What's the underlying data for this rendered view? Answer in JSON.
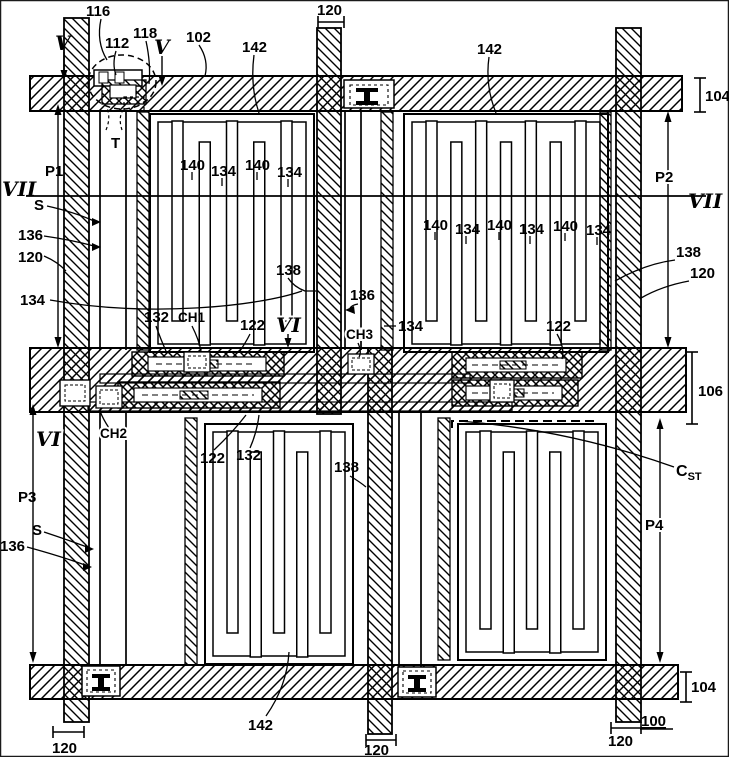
{
  "figure": {
    "type": "patent-drawing",
    "subject": "plan view of thin-film-transistor liquid crystal display pixel array with interdigitated comb electrodes, gate lines, data lines and storage capacitor",
    "section_lines": [
      "V",
      "VI",
      "VII"
    ],
    "labels": [
      {
        "name": "ref-116",
        "text": "116",
        "x": 86,
        "y": 16,
        "c": "num"
      },
      {
        "name": "ref-112",
        "text": "112",
        "x": 105,
        "y": 48,
        "c": "num"
      },
      {
        "name": "ref-118",
        "text": "118",
        "x": 133,
        "y": 38,
        "c": "num"
      },
      {
        "name": "ref-102",
        "text": "102",
        "x": 186,
        "y": 42,
        "c": "num"
      },
      {
        "name": "ref-142-top-left",
        "text": "142",
        "x": 242,
        "y": 52,
        "c": "num"
      },
      {
        "name": "ref-120-top",
        "text": "120",
        "x": 317,
        "y": 15,
        "c": "num"
      },
      {
        "name": "ref-142-top-right",
        "text": "142",
        "x": 477,
        "y": 54,
        "c": "num"
      },
      {
        "name": "ref-104-top",
        "text": "104",
        "x": 705,
        "y": 101,
        "c": "num"
      },
      {
        "name": "sec-V-1",
        "text": "V",
        "x": 55,
        "y": 50,
        "c": "sec",
        "fs": 15
      },
      {
        "name": "sec-V-2",
        "text": "V",
        "x": 154,
        "y": 54,
        "c": "sec",
        "fs": 15
      },
      {
        "name": "ref-T",
        "text": "T",
        "x": 111,
        "y": 148,
        "c": "num"
      },
      {
        "name": "ref-P1",
        "text": "P1",
        "x": 45,
        "y": 176,
        "c": "num"
      },
      {
        "name": "ref-P2",
        "text": "P2",
        "x": 655,
        "y": 182,
        "c": "num",
        "halo": true
      },
      {
        "name": "sec-VII-left",
        "text": "VII",
        "x": 2,
        "y": 196,
        "c": "sec"
      },
      {
        "name": "sec-VII-right",
        "text": "VII",
        "x": 688,
        "y": 208,
        "c": "sec"
      },
      {
        "name": "ref-S-top",
        "text": "S",
        "x": 34,
        "y": 210,
        "c": "num"
      },
      {
        "name": "ref-136-top-left",
        "text": "136",
        "x": 18,
        "y": 240,
        "c": "num"
      },
      {
        "name": "ref-120-left",
        "text": "120",
        "x": 18,
        "y": 262,
        "c": "num"
      },
      {
        "name": "ref-134-left",
        "text": "134",
        "x": 20,
        "y": 305,
        "c": "num"
      },
      {
        "name": "ref-140-a",
        "text": "140",
        "x": 180,
        "y": 170,
        "c": "num"
      },
      {
        "name": "ref-134-a",
        "text": "134",
        "x": 211,
        "y": 176,
        "c": "num"
      },
      {
        "name": "ref-140-b",
        "text": "140",
        "x": 245,
        "y": 170,
        "c": "num"
      },
      {
        "name": "ref-134-b",
        "text": "134",
        "x": 277,
        "y": 177,
        "c": "num"
      },
      {
        "name": "ref-140-c",
        "text": "140",
        "x": 423,
        "y": 230,
        "c": "num"
      },
      {
        "name": "ref-134-c",
        "text": "134",
        "x": 455,
        "y": 234,
        "c": "num"
      },
      {
        "name": "ref-140-d",
        "text": "140",
        "x": 487,
        "y": 230,
        "c": "num"
      },
      {
        "name": "ref-134-d",
        "text": "134",
        "x": 519,
        "y": 234,
        "c": "num"
      },
      {
        "name": "ref-140-e",
        "text": "140",
        "x": 553,
        "y": 231,
        "c": "num"
      },
      {
        "name": "ref-134-e",
        "text": "134",
        "x": 586,
        "y": 235,
        "c": "num"
      },
      {
        "name": "ref-138-center",
        "text": "138",
        "x": 276,
        "y": 275,
        "c": "num"
      },
      {
        "name": "ref-136-center",
        "text": "136",
        "x": 350,
        "y": 300,
        "c": "num"
      },
      {
        "name": "ref-138-right",
        "text": "138",
        "x": 676,
        "y": 257,
        "c": "num"
      },
      {
        "name": "ref-120-right",
        "text": "120",
        "x": 690,
        "y": 278,
        "c": "num"
      },
      {
        "name": "ref-134-center",
        "text": "134",
        "x": 398,
        "y": 331,
        "c": "num"
      },
      {
        "name": "ref-132-top",
        "text": "132",
        "x": 144,
        "y": 322,
        "c": "num"
      },
      {
        "name": "ref-CH1",
        "text": "CH1",
        "x": 178,
        "y": 322,
        "c": "numS"
      },
      {
        "name": "ref-122-top",
        "text": "122",
        "x": 240,
        "y": 330,
        "c": "num"
      },
      {
        "name": "sec-VI-top",
        "text": "VI",
        "x": 276,
        "y": 332,
        "c": "sec",
        "fs": 16,
        "halo": true
      },
      {
        "name": "ref-CH3",
        "text": "CH3",
        "x": 346,
        "y": 339,
        "c": "numS",
        "halo": true
      },
      {
        "name": "ref-122-right",
        "text": "122",
        "x": 546,
        "y": 331,
        "c": "num"
      },
      {
        "name": "ref-106",
        "text": "106",
        "x": 698,
        "y": 396,
        "c": "num"
      },
      {
        "name": "sec-VI-bottom",
        "text": "VI",
        "x": 36,
        "y": 446,
        "c": "sec",
        "fs": 16,
        "halo": true
      },
      {
        "name": "ref-CH2",
        "text": "CH2",
        "x": 100,
        "y": 438,
        "c": "numS",
        "halo": true
      },
      {
        "name": "ref-122-bottom",
        "text": "122",
        "x": 200,
        "y": 463,
        "c": "num"
      },
      {
        "name": "ref-132-bottom",
        "text": "132",
        "x": 236,
        "y": 460,
        "c": "num"
      },
      {
        "name": "ref-138-bottom",
        "text": "138",
        "x": 334,
        "y": 472,
        "c": "num"
      },
      {
        "name": "ref-C-ST",
        "text": "C",
        "sub": "ST",
        "x": 676,
        "y": 476,
        "c": "cst"
      },
      {
        "name": "ref-P3",
        "text": "P3",
        "x": 18,
        "y": 502,
        "c": "num"
      },
      {
        "name": "ref-S-bottom",
        "text": "S",
        "x": 32,
        "y": 535,
        "c": "num"
      },
      {
        "name": "ref-136-bottom",
        "text": "136",
        "x": 0,
        "y": 551,
        "c": "num"
      },
      {
        "name": "ref-P4",
        "text": "P4",
        "x": 645,
        "y": 530,
        "c": "num",
        "halo": true
      },
      {
        "name": "ref-104-bottom",
        "text": "104",
        "x": 691,
        "y": 692,
        "c": "num"
      },
      {
        "name": "ref-100",
        "text": "100",
        "x": 641,
        "y": 726,
        "c": "num",
        "ul": true
      },
      {
        "name": "ref-142-bottom",
        "text": "142",
        "x": 248,
        "y": 730,
        "c": "num"
      },
      {
        "name": "ref-120-bottom-left",
        "text": "120",
        "x": 52,
        "y": 753,
        "c": "num"
      },
      {
        "name": "ref-120-bottom-mid",
        "text": "120",
        "x": 364,
        "y": 755,
        "c": "num"
      },
      {
        "name": "ref-120-bottom-right",
        "text": "120",
        "x": 608,
        "y": 746,
        "c": "num"
      }
    ]
  }
}
